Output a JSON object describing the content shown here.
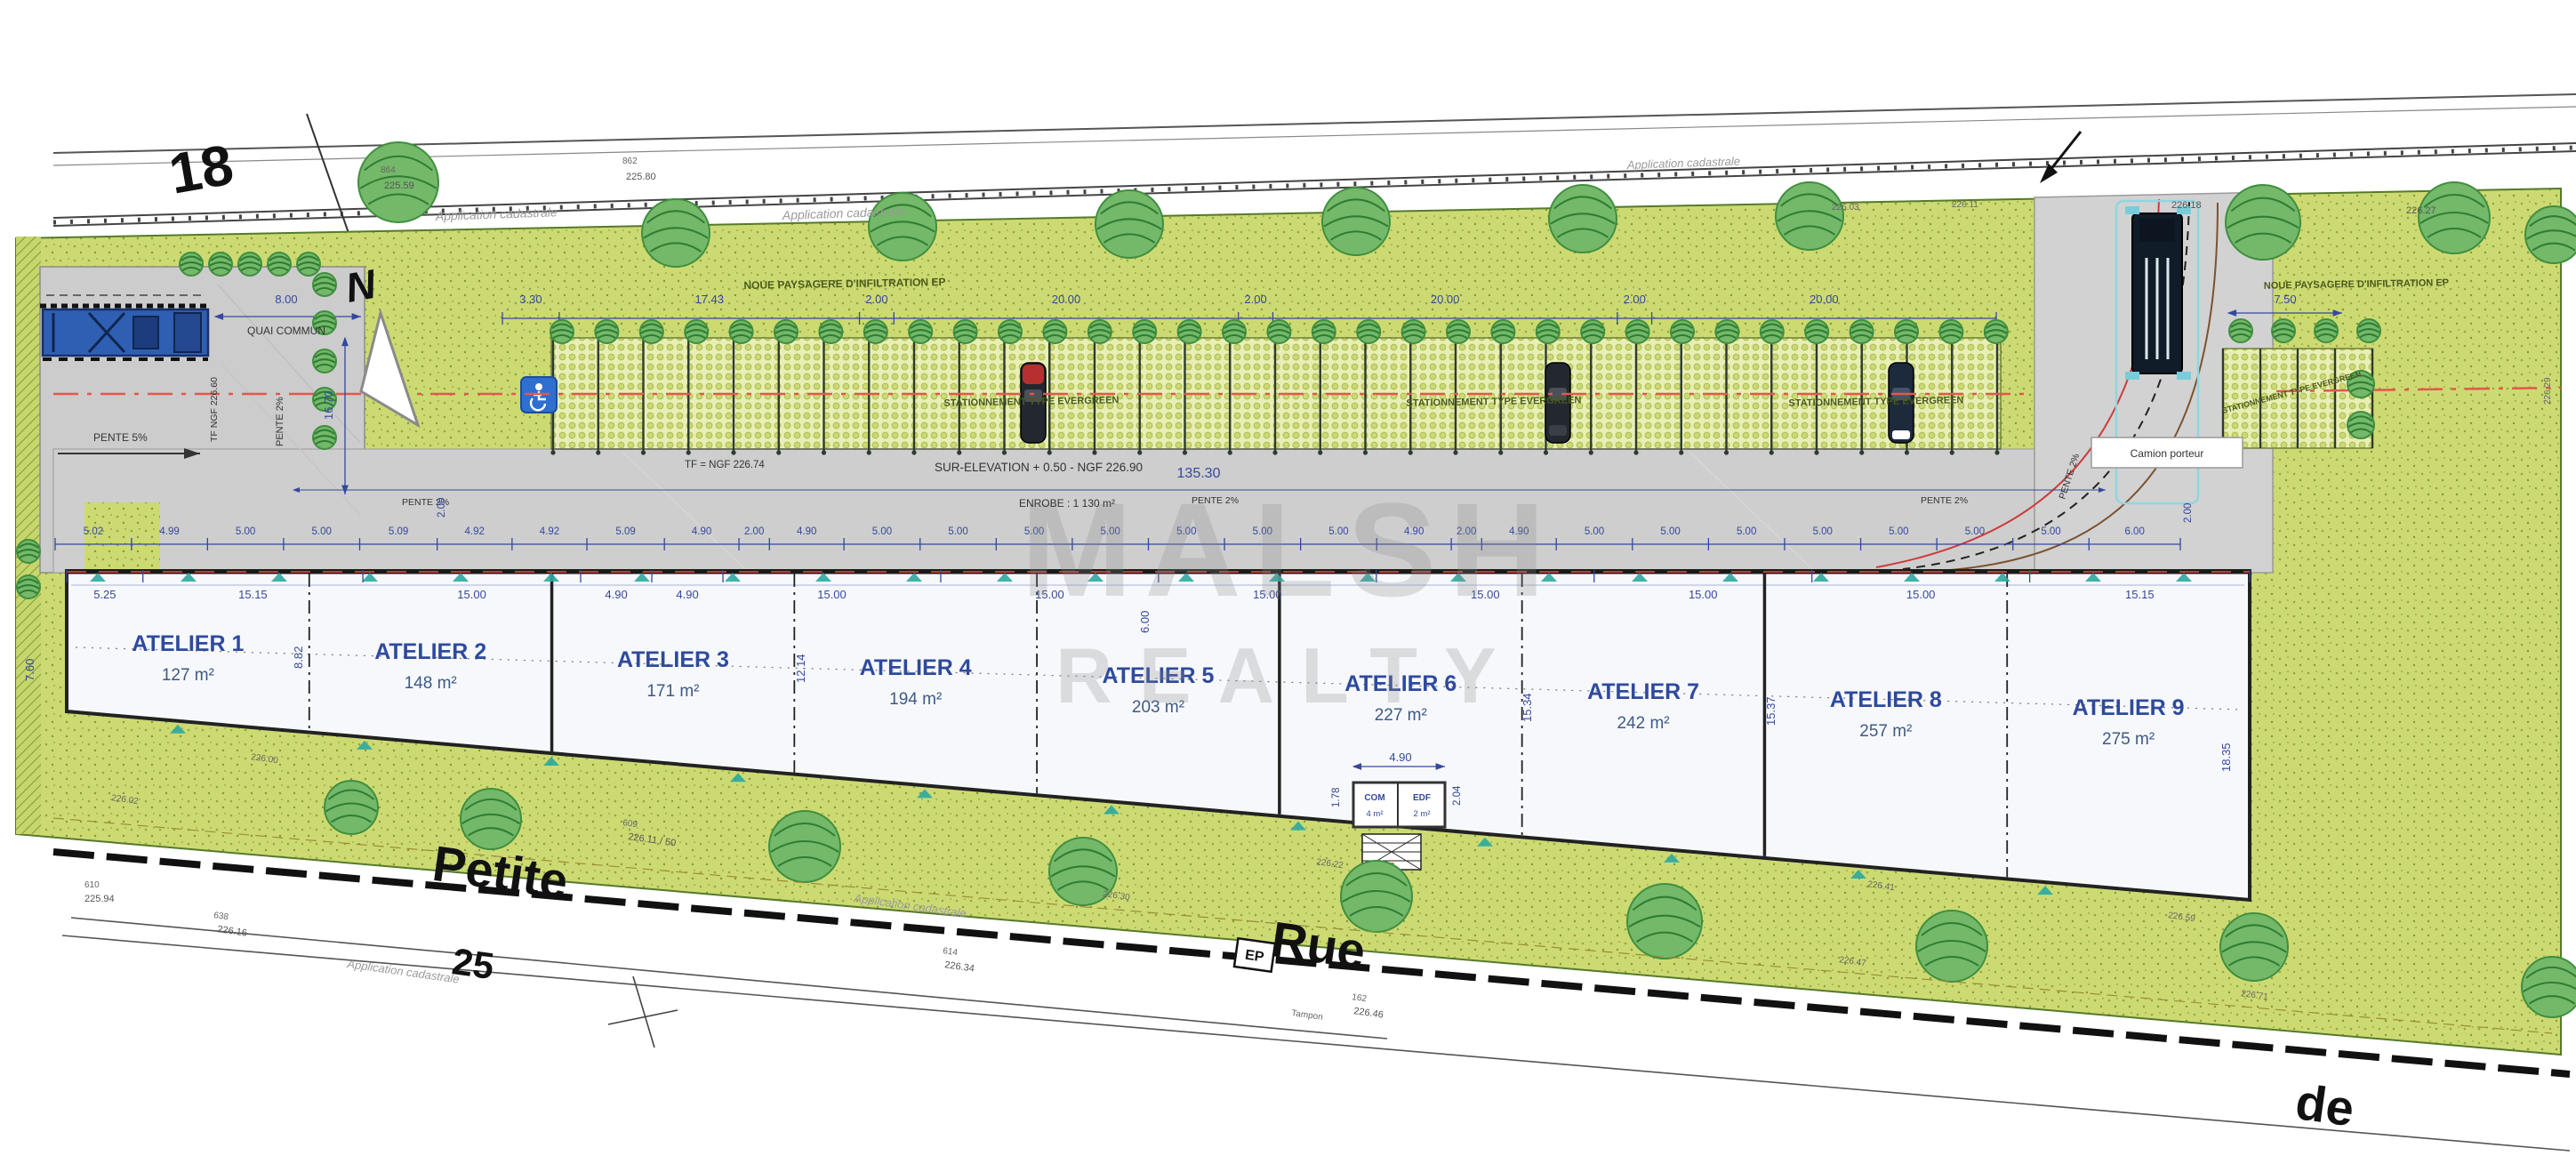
{
  "parcels": {
    "road_top": "18",
    "road_bottom": "25"
  },
  "street_words": {
    "w1": "Petite",
    "w2": "Rue",
    "w3": "de"
  },
  "compass": "N",
  "watermark": {
    "line1": "MALSH",
    "line2": "REALTY"
  },
  "notes": {
    "cadastre": "Application cadastrale",
    "noue": "NOUE PAYSAGERE D'INFILTRATION EP",
    "stationnement": "STATIONNEMENT TYPE EVERGREEN",
    "camion": "Camion porteur",
    "tampon": "Tampon",
    "ep": "EP"
  },
  "labels": {
    "quai": "QUAI COMMUN",
    "pente5": "PENTE 5%",
    "pente2": "PENTE 2%",
    "tf_quai": "TF NGF 226.60",
    "tf_road": "TF = NGF 226.74",
    "surelevation": "SUR-ELEVATION + 0.50 - NGF 226.90",
    "enrobe": "ENROBE : 1 130 m²",
    "com": "COM",
    "com_area": "4 m²",
    "edf": "EDF",
    "edf_area": "2 m²"
  },
  "dimensions": {
    "parking_row": [
      "3.30",
      "17.43",
      "2.00",
      "20.00",
      "2.00",
      "20.00",
      "2.00",
      "20.00"
    ],
    "entrance_width": "7.50",
    "quai_width": "8.00",
    "quai_length": "16.70",
    "total_length": "135.30",
    "canopy_gap": "2.00",
    "building_bays": [
      "5.02",
      "4.99",
      "5.00",
      "5.00",
      "5.09",
      "4.92",
      "4.92",
      "5.09",
      "4.90",
      "2.00",
      "4.90",
      "5.00",
      "5.00",
      "5.00",
      "5.00",
      "5.00",
      "5.00",
      "5.00",
      "4.90",
      "2.00",
      "4.90",
      "5.00",
      "5.00",
      "5.00",
      "5.00",
      "5.00",
      "5.00",
      "5.00",
      "6.00"
    ],
    "unit_widths": [
      "5.25",
      "15.15",
      "15.00",
      "4.90",
      "4.90",
      "15.00",
      "15.00",
      "15.00",
      "15.00",
      "15.00",
      "15.00",
      "15.15"
    ],
    "unit_depths": [
      "8.82",
      "12.14",
      "6.00",
      "15.34",
      "15.37",
      "18.35"
    ],
    "left_depth": "7.60",
    "local_width": "4.90",
    "local_d1": "1.78",
    "local_d2": "2.04"
  },
  "units": [
    {
      "name": "ATELIER 1",
      "area": "127 m²"
    },
    {
      "name": "ATELIER 2",
      "area": "148 m²"
    },
    {
      "name": "ATELIER 3",
      "area": "171 m²"
    },
    {
      "name": "ATELIER 4",
      "area": "194 m²"
    },
    {
      "name": "ATELIER 5",
      "area": "203 m²"
    },
    {
      "name": "ATELIER 6",
      "area": "227 m²"
    },
    {
      "name": "ATELIER 7",
      "area": "242 m²"
    },
    {
      "name": "ATELIER 8",
      "area": "257 m²"
    },
    {
      "name": "ATELIER 9",
      "area": "275 m²"
    }
  ],
  "survey": {
    "top": [
      {
        "id": "864",
        "level": "225.59"
      },
      {
        "id": "862",
        "level": "225.80"
      }
    ],
    "top_right": [
      "226.03",
      "226.11",
      "226.18",
      "226.27"
    ],
    "bottom": [
      {
        "id": "610",
        "level": "225.94"
      },
      {
        "id": "609",
        "level": "226.11 / 50"
      },
      {
        "id": "638",
        "level": "226.16"
      },
      {
        "id": "614",
        "level": "226.34"
      },
      {
        "id": "162",
        "level": "226.46"
      }
    ],
    "green": [
      "226.02",
      "226.22",
      "226.30",
      "226.41",
      "226.47",
      "226.59",
      "226.71"
    ],
    "right_edge": "226.29",
    "ground": "226.00"
  }
}
